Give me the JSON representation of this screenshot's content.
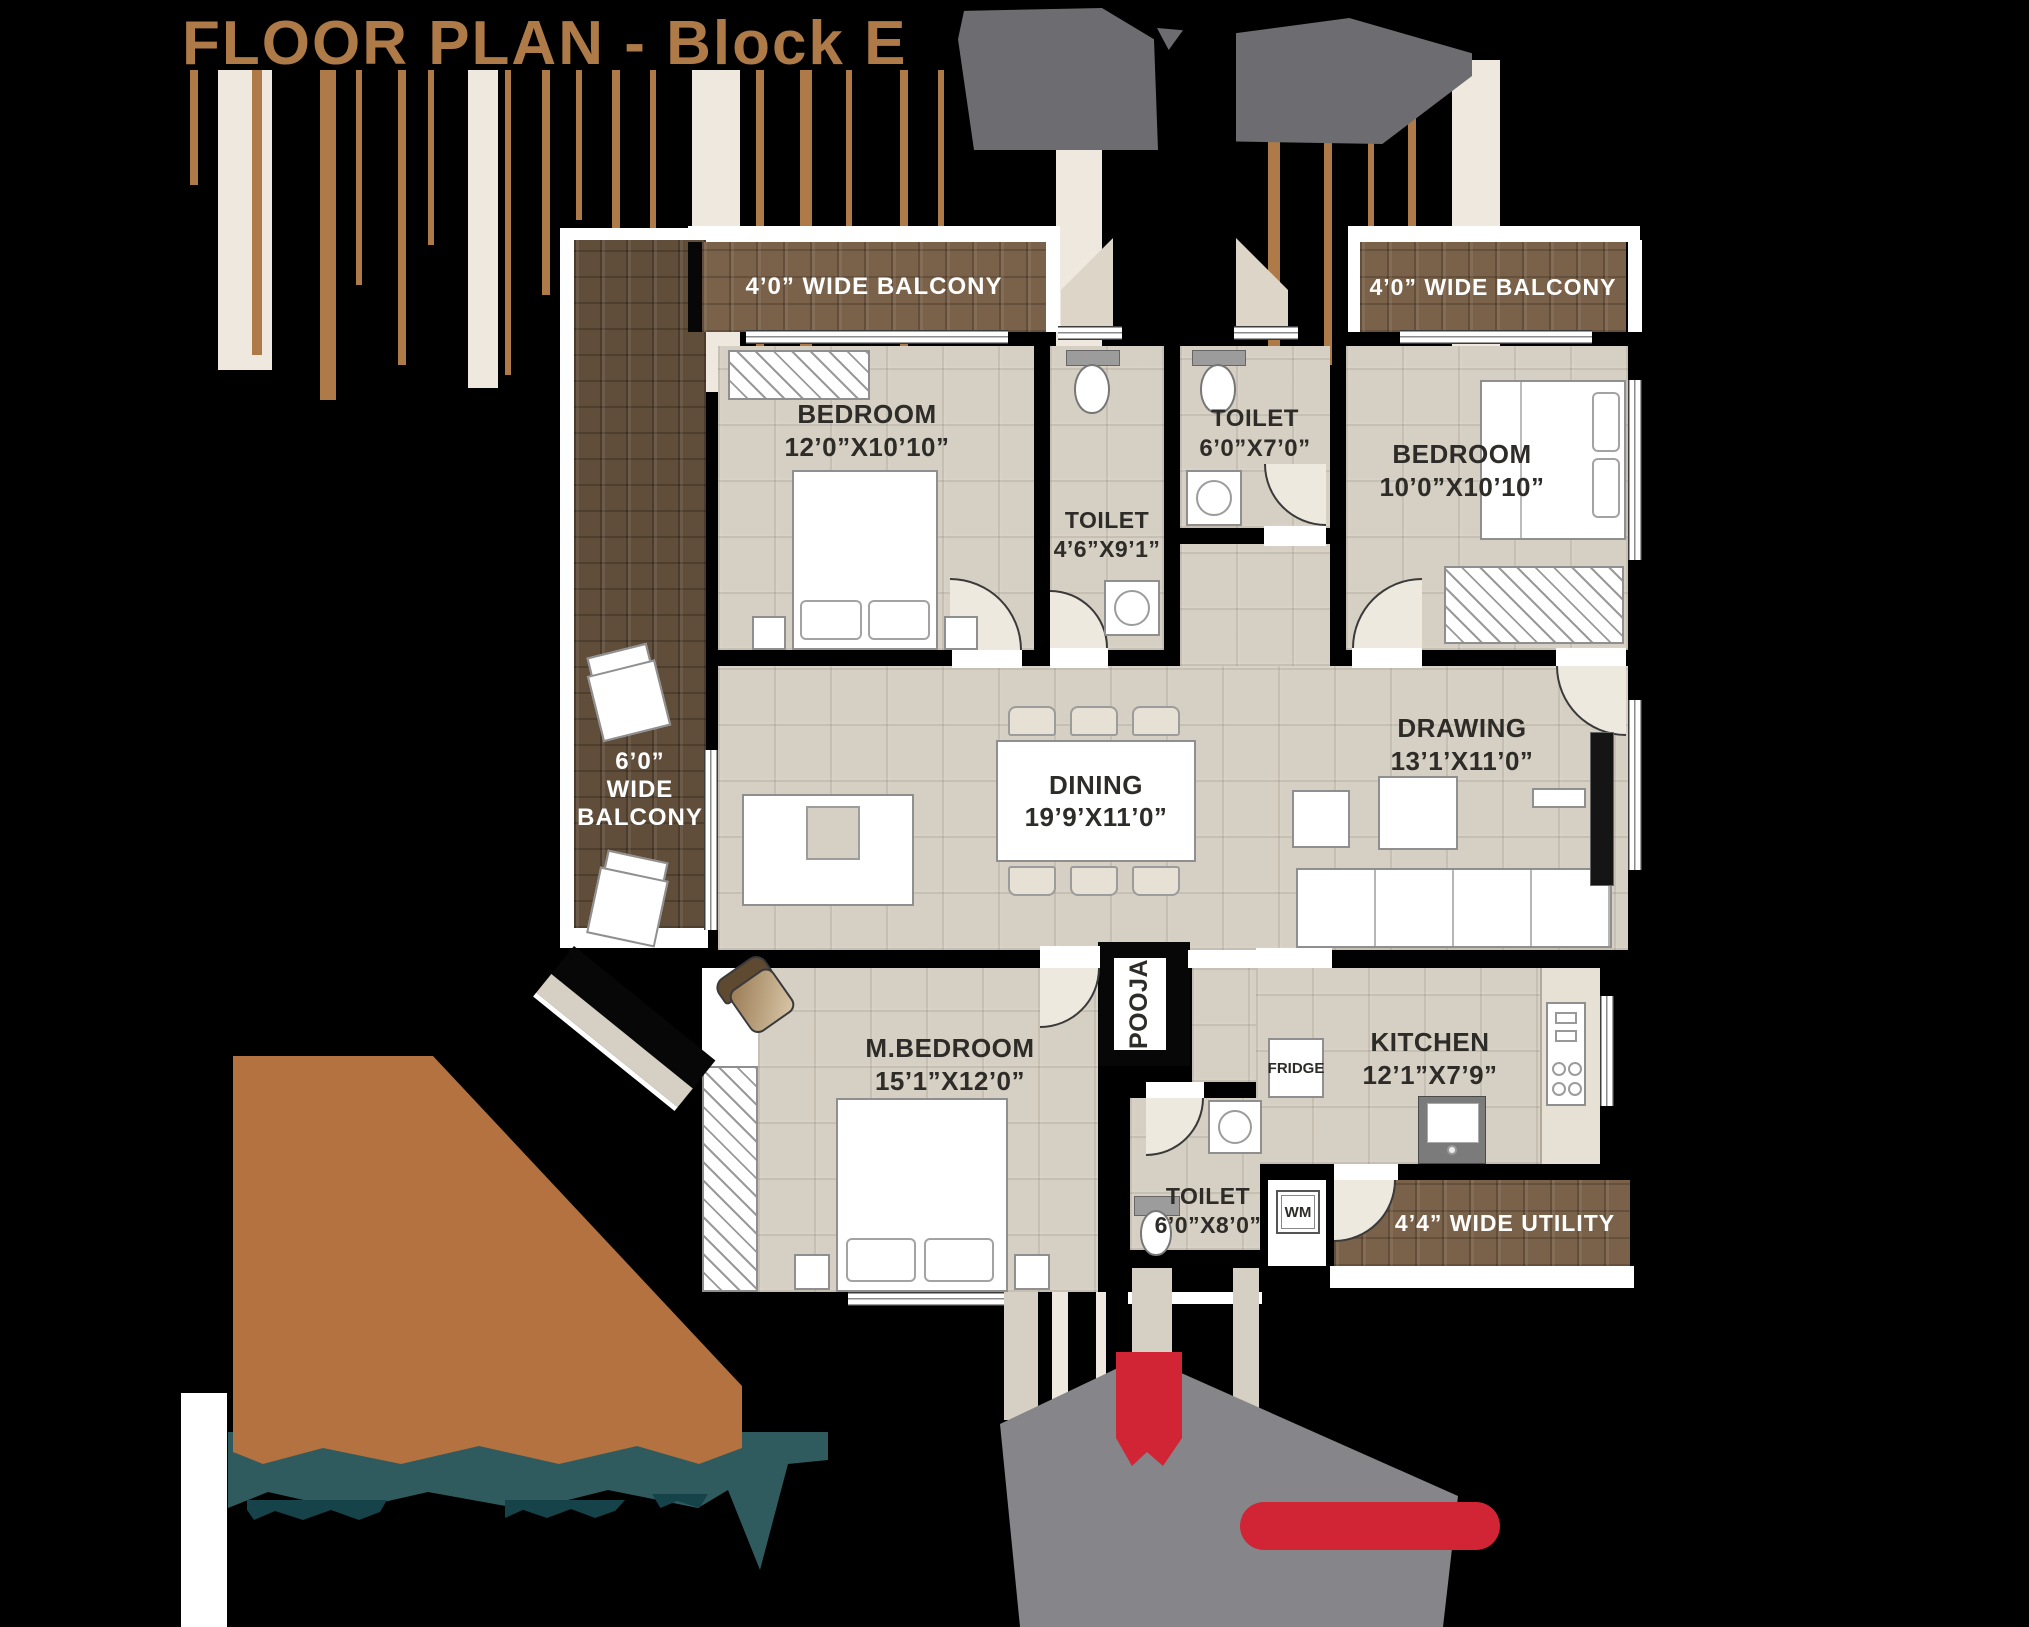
{
  "title": "FLOOR PLAN - Block E",
  "palette": {
    "background": "#000000",
    "title_brown": "#ad7a48",
    "floor_beige": "#d6cfc3",
    "balcony_brown": "#7a6149",
    "balcony_dark_brown": "#604d3a",
    "teal": "#2f5b5e",
    "orange_blob": "#b3723f",
    "gray_smear": "#86868a",
    "red_accent": "#d12434",
    "label_dark": "#2e2c28"
  },
  "rooms": {
    "bedroom_top_left": {
      "name": "BEDROOM",
      "dims": "12’0”X10’10”"
    },
    "toilet_mid": {
      "name": "TOILET",
      "dims": "4’6”X9’1”"
    },
    "toilet_top": {
      "name": "TOILET",
      "dims": "6’0”X7’0”"
    },
    "bedroom_top_right": {
      "name": "BEDROOM",
      "dims": "10’0”X10’10”"
    },
    "dining": {
      "name": "DINING",
      "dims": "19’9’X11’0”"
    },
    "drawing": {
      "name": "DRAWING",
      "dims": "13’1’X11’0”"
    },
    "master_bedroom": {
      "name": "M.BEDROOM",
      "dims": "15’1”X12’0”"
    },
    "kitchen": {
      "name": "KITCHEN",
      "dims": "12’1”X7’9”"
    },
    "toilet_bottom": {
      "name": "TOILET",
      "dims": "6’0”X8’0”"
    },
    "pooja": {
      "name": "POOJA"
    }
  },
  "balconies": {
    "top_left": "4’0” WIDE BALCONY",
    "top_right": "4’0” WIDE BALCONY",
    "left": "6’0”\nWIDE\nBALCONY",
    "utility": "4’4” WIDE UTILITY"
  },
  "appliances": {
    "fridge": "FRIDGE",
    "washing_machine": "WM"
  }
}
